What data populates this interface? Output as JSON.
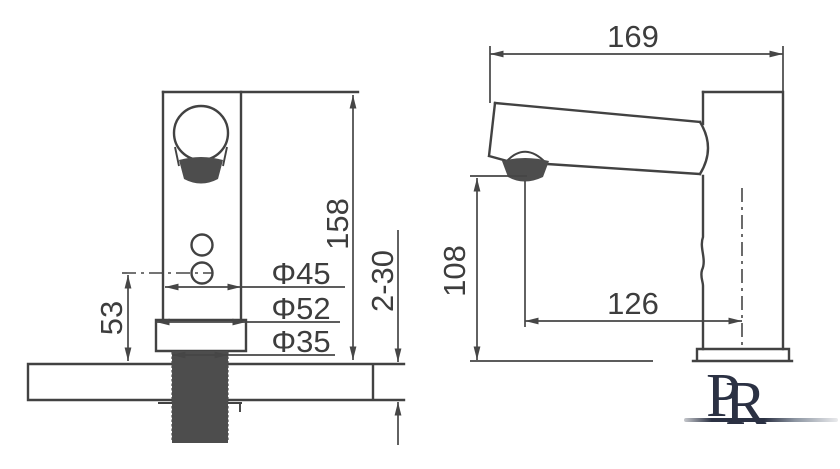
{
  "title": "faucet-technical-dimension-drawing",
  "colors": {
    "line": "#424242",
    "text": "#3d3d3d",
    "dark_fill": "#4d4d4d",
    "logo": "#2b3143"
  },
  "dims": {
    "total_height": "158",
    "sensor_height": "53",
    "body_diameter": "Φ45",
    "base_diameter": "Φ52",
    "shank_diameter": "Φ35",
    "deck_thickness": "2-30",
    "total_length": "169",
    "outlet_height": "108",
    "spout_reach": "126"
  },
  "logo": {
    "letter_back": "P",
    "letter_front": "R"
  }
}
